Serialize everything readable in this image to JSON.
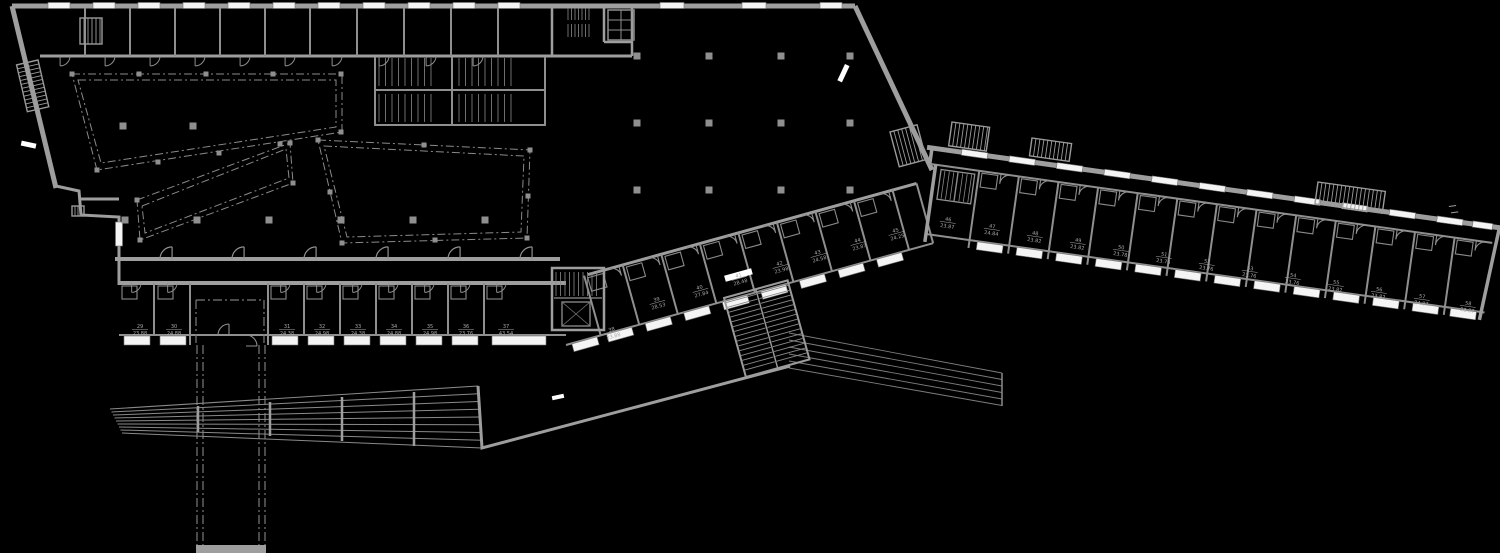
{
  "canvas": {
    "width": 1500,
    "height": 553,
    "background": "#000000"
  },
  "palette": {
    "wall": "#9e9e9e",
    "line": "#848484",
    "faint": "#6a6a6a",
    "dash": "#7a7a7a",
    "window": "#f4f4f4",
    "column": "#8f8f8f",
    "label": "#a9a9a9",
    "highlight_bg": "#ffffff",
    "highlight_text": "#1a1a1a"
  },
  "plan": {
    "type": "architectural-floor-plan"
  },
  "rooms": {
    "bottom_row": [
      {
        "num": "29",
        "area": "23.88",
        "x": 140,
        "y": 328,
        "rot": 0
      },
      {
        "num": "30",
        "area": "24.88",
        "x": 174,
        "y": 328,
        "rot": 0
      },
      {
        "num": "31",
        "area": "24.38",
        "x": 287,
        "y": 328,
        "rot": 0
      },
      {
        "num": "32",
        "area": "24.98",
        "x": 322,
        "y": 328,
        "rot": 0
      },
      {
        "num": "33",
        "area": "24.38",
        "x": 358,
        "y": 328,
        "rot": 0
      },
      {
        "num": "34",
        "area": "24.88",
        "x": 394,
        "y": 328,
        "rot": 0
      },
      {
        "num": "35",
        "area": "24.98",
        "x": 430,
        "y": 328,
        "rot": 0
      },
      {
        "num": "36",
        "area": "23.76",
        "x": 466,
        "y": 328,
        "rot": 0
      },
      {
        "num": "37",
        "area": "43.54",
        "x": 506,
        "y": 328,
        "rot": 0
      },
      {
        "num": "38",
        "area": "23.88",
        "x": 612,
        "y": 331,
        "rot": -15.5
      }
    ],
    "middle_band": [
      {
        "num": "39",
        "area": "28.53",
        "x": 657,
        "y": 301,
        "rot": -15.5
      },
      {
        "num": "40",
        "area": "27.84",
        "x": 700,
        "y": 289,
        "rot": -15.5
      },
      {
        "num": "41",
        "area": "28.48",
        "x": 739,
        "y": 277,
        "rot": -15.5,
        "hl": true
      },
      {
        "num": "42",
        "area": "23.98",
        "x": 780,
        "y": 265,
        "rot": -15.5
      },
      {
        "num": "43",
        "area": "24.58",
        "x": 818,
        "y": 254,
        "rot": -15.5
      },
      {
        "num": "44",
        "area": "23.87",
        "x": 858,
        "y": 242,
        "rot": -15.5
      },
      {
        "num": "45",
        "area": "24.25",
        "x": 896,
        "y": 232,
        "rot": -15.5
      }
    ],
    "right_wing": [
      {
        "num": "46",
        "area": "23.87",
        "x": 948,
        "y": 221,
        "rot": 8
      },
      {
        "num": "47",
        "area": "24.84",
        "x": 992,
        "y": 228,
        "rot": 8
      },
      {
        "num": "48",
        "area": "23.82",
        "x": 1035,
        "y": 235,
        "rot": 8
      },
      {
        "num": "49",
        "area": "23.82",
        "x": 1078,
        "y": 242,
        "rot": 8
      },
      {
        "num": "50",
        "area": "23.78",
        "x": 1121,
        "y": 249,
        "rot": 8
      },
      {
        "num": "51",
        "area": "23.76",
        "x": 1164,
        "y": 256,
        "rot": 8
      },
      {
        "num": "52",
        "area": "23.76",
        "x": 1207,
        "y": 263,
        "rot": 8
      },
      {
        "num": "53",
        "area": "23.76",
        "x": 1250,
        "y": 270,
        "rot": 8
      },
      {
        "num": "54",
        "area": "23.76",
        "x": 1293,
        "y": 277,
        "rot": 8
      },
      {
        "num": "55",
        "area": "23.82",
        "x": 1336,
        "y": 284,
        "rot": 8
      },
      {
        "num": "56",
        "area": "23.82",
        "x": 1379,
        "y": 291,
        "rot": 8
      },
      {
        "num": "57",
        "area": "24.87",
        "x": 1422,
        "y": 298,
        "rot": 8
      },
      {
        "num": "58",
        "area": "28.87",
        "x": 1468,
        "y": 305,
        "rot": 8
      }
    ]
  }
}
